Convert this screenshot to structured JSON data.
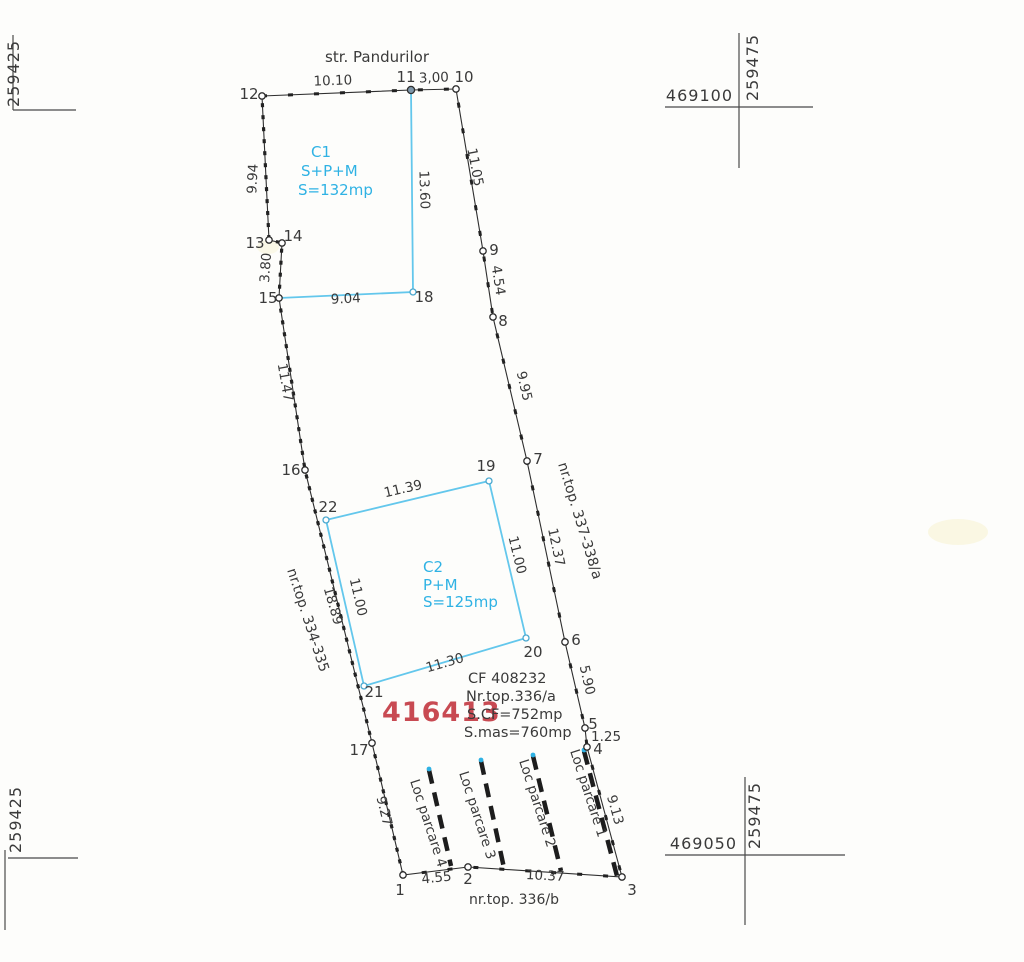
{
  "street_label": "str. Pandurilor",
  "grid": {
    "tl_easting": "259425",
    "bl_easting": "259425",
    "tr_easting": "259475",
    "br_easting": "259475",
    "tr_northing": "469100",
    "br_northing": "469050"
  },
  "buildings": {
    "c1": {
      "name": "C1",
      "regime": "S+P+M",
      "area": "S=132mp"
    },
    "c2": {
      "name": "C2",
      "regime": "P+M",
      "area": "S=125mp"
    }
  },
  "parcel": {
    "cad_number": "416413",
    "cf": "CF 408232",
    "nr_top": "Nr.top.336/a",
    "s_cf": "S.CF=752mp",
    "s_mas": "S.mas=760mp"
  },
  "neighbors": {
    "left": "nr.top. 334-335",
    "right": "nr.top. 337-338/a",
    "bottom": "nr.top. 336/b"
  },
  "parking": {
    "p1": "Loc parcare 1",
    "p2": "Loc parcare 2",
    "p3": "Loc parcare 3",
    "p4": "Loc parcare 4"
  },
  "points": {
    "p1": "1",
    "p2": "2",
    "p3": "3",
    "p4": "4",
    "p5": "5",
    "p6": "6",
    "p7": "7",
    "p8": "8",
    "p9": "9",
    "p10": "10",
    "p11": "11",
    "p12": "12",
    "p13": "13",
    "p14": "14",
    "p15": "15",
    "p16": "16",
    "p17": "17",
    "p18": "18",
    "p19": "19",
    "p20": "20",
    "p21": "21",
    "p22": "22"
  },
  "dims": {
    "d12_11": "10.10",
    "d11_10": "3,00",
    "d10_9": "11.05",
    "d9_8": "4.54",
    "d8_7": "9.95",
    "d7_6": "12.37",
    "d6_5": "5.90",
    "d5_4": "1.25",
    "d4_3": "9.13",
    "d1_2": "4.55",
    "d2_3": "10.37",
    "d17_1": "9.27",
    "d16_17": "18.89",
    "d15_16": "11.47",
    "d14_15": "3.80",
    "d12_13": "9.94",
    "d15_18": "9.04",
    "d11_18": "13.60",
    "d22_19": "11.39",
    "d19_20": "11.00",
    "d20_21": "11.30",
    "d21_22": "11.00"
  },
  "colors": {
    "accent_cyan": "#2fb2e4",
    "cad_red": "#c84a52",
    "ink": "#3a3a3a"
  }
}
